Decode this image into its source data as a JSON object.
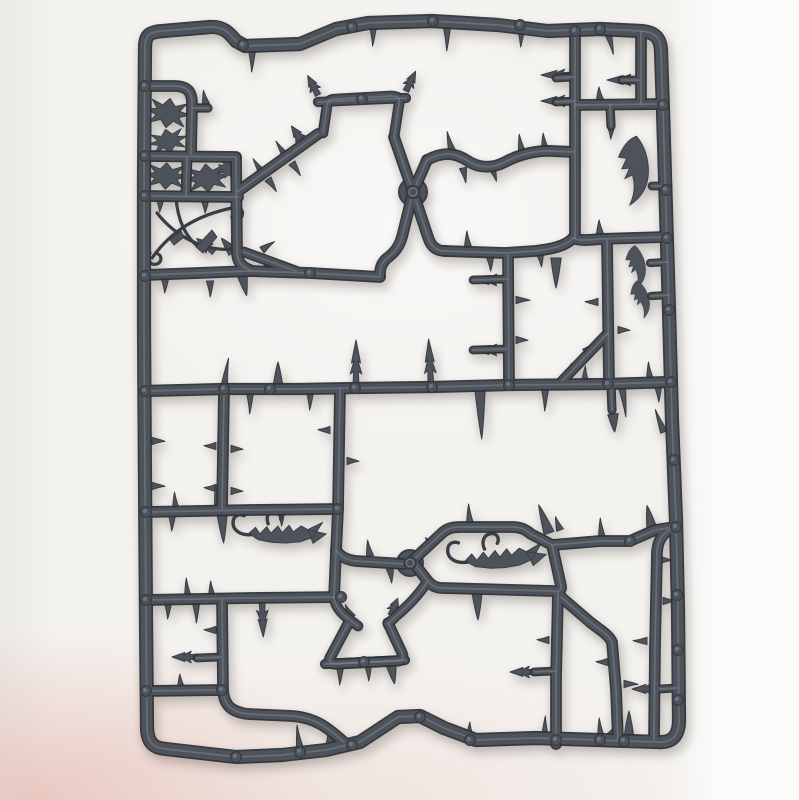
{
  "meta": {
    "subject": "Grey plastic injection-moulded sprue (model-kit runner frame) holding thorn, spike, hook and blade shaped scenery parts",
    "background": "White paper surface with soft photo shadows and a faint pink reflection along the bottom-left edge",
    "item_color_name": "dark grey polystyrene plastic",
    "orientation": "portrait photograph"
  },
  "palette": {
    "background_base": "#f4f2ef",
    "background_right": "#fcfcfb",
    "background_left": "#eceae7",
    "pink_tint_strong": "rgba(226,168,158,0.55)",
    "pink_tint_fade": "rgba(226,168,158,0)",
    "plastic": "#4e535b",
    "plastic_dark": "#393d44",
    "plastic_deep": "#2e3137",
    "plastic_light": "#8a909a"
  },
  "geometry": {
    "canvas": {
      "width": 799,
      "height": 800
    },
    "frame": {
      "d": "M 163,31 L 210,27 C 224,26 230,34 236,41 L 245,46 L 300,44 L 336,29 L 368,23 L 432,21 L 498,25 L 548,31 L 600,29 L 641,31 C 655,32 661,38 661,52 L 663,110 L 666,210 L 669,310 L 672,420 L 676,520 L 678,610 L 679,720 C 679,736 672,743 658,742 L 598,740 L 536,738 L 476,740 L 444,728 L 420,716 L 398,717 L 360,742 L 326,750 L 282,755 L 236,757 L 192,752 L 166,749 C 152,748 147,741 147,726 L 146,620 L 145,480 L 144,330 L 144,180 L 145,48 C 145,34 150,32 163,31 Z",
      "w": 12
    },
    "rails": [
      {
        "d": "M 145,391 L 224,389 L 300,389 L 355,388 L 432,387 L 509,385 L 608,384 L 671,382",
        "w": 10
      },
      {
        "d": "M 146,86 L 174,86 C 188,86 192,92 192,104 L 191,154",
        "w": 9.5
      },
      {
        "d": "M 192,108 L 208,108",
        "w": 7
      },
      {
        "d": "M 146,156 L 236,157",
        "w": 9.5
      },
      {
        "d": "M 187,158 L 186,196",
        "w": 8.5
      },
      {
        "d": "M 146,196 L 238,197",
        "w": 9.5
      },
      {
        "d": "M 236,158 L 237,252 C 237,262 242,267 250,270",
        "w": 9.5
      },
      {
        "d": "M 146,275 L 250,271 L 310,273 L 380,277",
        "w": 9.5
      },
      {
        "d": "M 237,192 L 318,134",
        "w": 9.5
      },
      {
        "d": "M 244,252 L 296,271",
        "w": 8.5
      },
      {
        "d": "M 323,133 L 327,106 C 328,100 331,99 337,99 L 391,96 C 398,96 400,98 399,104 L 394,137",
        "w": 8.5
      },
      {
        "d": "M 318,102 L 406,98",
        "w": 8
      },
      {
        "d": "M 394,137 L 413,192 L 428,237 C 431,247 437,251 445,251",
        "w": 9.5
      },
      {
        "d": "M 427,160 L 413,192 L 403,233 C 400,247 394,253 386,259 C 381,264 380,269 380,275",
        "w": 9.5
      },
      {
        "d": "M 427,160 C 444,151 456,153 468,161 C 480,169 494,168 505,162 C 520,154 538,150 552,151 L 574,152",
        "w": 9.5
      },
      {
        "d": "M 445,251 L 505,253 L 535,251 C 552,249 566,246 573,238",
        "w": 9.5
      },
      {
        "d": "M 575,31 L 575,238",
        "w": 9.5
      },
      {
        "d": "M 573,238 C 580,241 590,240 600,239 L 664,237",
        "w": 9.5
      },
      {
        "d": "M 607,240 L 609,384",
        "w": 9.5
      },
      {
        "d": "M 508,255 L 509,385",
        "w": 9.5
      },
      {
        "d": "M 575,105 L 662,104",
        "w": 9.5
      },
      {
        "d": "M 641,32 L 641,104",
        "w": 9.5
      },
      {
        "d": "M 610,104 L 611,126",
        "w": 7
      },
      {
        "d": "M 611,385 L 612,410",
        "w": 7
      },
      {
        "d": "M 562,381 L 608,333",
        "w": 8.5
      },
      {
        "d": "M 340,389 L 338,510 L 336,552 L 334,598",
        "w": 9.5
      },
      {
        "d": "M 336,550 C 340,557 348,560 356,561 L 404,564",
        "w": 9.5
      },
      {
        "d": "M 334,598 C 336,608 342,614 350,620 L 358,626",
        "w": 8.5
      },
      {
        "d": "M 146,512 L 250,510 L 338,509",
        "w": 9.5
      },
      {
        "d": "M 146,600 L 250,598 L 341,597",
        "w": 9.5
      },
      {
        "d": "M 224,390 L 222,509",
        "w": 9.5
      },
      {
        "d": "M 222,600 L 223,690 C 224,706 232,712 248,714 L 292,716 C 318,718 330,730 344,742",
        "w": 9.5
      },
      {
        "d": "M 146,691 L 222,690",
        "w": 9.5
      },
      {
        "d": "M 412,561 L 441,534 C 447,528 453,527 461,527 L 512,527 C 520,527 525,529 531,534 L 552,545 L 561,586 C 562,591 558,592 552,591 L 443,588 C 435,588 431,585 427,580 Z",
        "w": 9.5
      },
      {
        "d": "M 552,545 L 600,541 L 630,541 L 655,530 L 674,527",
        "w": 9.5
      },
      {
        "d": "M 558,592 L 556,680 L 556,744",
        "w": 9.5
      },
      {
        "d": "M 561,597 L 590,622 C 600,630 608,634 612,642 L 616,690 L 618,740",
        "w": 9.5
      },
      {
        "d": "M 672,528 C 662,534 658,540 657,552 L 655,648 L 654,740",
        "w": 9.5
      },
      {
        "d": "M 427,582 C 418,596 408,606 396,616 L 388,624",
        "w": 8.5
      },
      {
        "d": "M 348,624 L 331,656 C 328,661 330,664 335,664 L 397,661 C 402,661 404,658 402,653 L 388,623",
        "w": 9
      },
      {
        "d": "M 325,664 L 405,660",
        "w": 8
      },
      {
        "d": "M 652,186 L 668,186",
        "w": 6.5
      },
      {
        "d": "M 650,263 L 668,262",
        "w": 6
      },
      {
        "d": "M 651,296 L 669,295",
        "w": 6
      },
      {
        "d": "M 660,689 L 677,688",
        "w": 6.5
      },
      {
        "d": "M 197,658 L 221,657",
        "w": 6.5
      },
      {
        "d": "M 534,672 L 555,671",
        "w": 6.5
      },
      {
        "d": "M 473,280 L 507,279",
        "w": 6.5
      },
      {
        "d": "M 473,350 L 507,349",
        "w": 6.5
      },
      {
        "d": "M 556,78 L 574,77",
        "w": 6.5
      },
      {
        "d": "M 556,102 L 574,101",
        "w": 6.5
      },
      {
        "d": "M 622,80 L 640,80",
        "w": 6.5
      }
    ],
    "spikes": [
      [
        "thorn",
        252,
        50,
        180,
        22
      ],
      [
        "thorn",
        373,
        26,
        180,
        20
      ],
      [
        "thorn",
        447,
        27,
        180,
        24
      ],
      [
        "thorn",
        521,
        29,
        180,
        18
      ],
      [
        "thorn",
        608,
        33,
        165,
        22
      ],
      [
        "thorn",
        262,
        172,
        -35,
        16
      ],
      [
        "thorn",
        268,
        179,
        145,
        15
      ],
      [
        "thorn",
        286,
        156,
        -35,
        18
      ],
      [
        "thorn",
        292,
        163,
        145,
        15
      ],
      [
        "arrow",
        304,
        144,
        -35,
        22
      ],
      [
        "thorn",
        262,
        250,
        55,
        15
      ],
      [
        "thorn",
        271,
        263,
        -125,
        14
      ],
      [
        "arrow",
        318,
        95,
        -28,
        22
      ],
      [
        "arrow",
        406,
        91,
        26,
        22
      ],
      [
        "thorn",
        452,
        151,
        -15,
        20
      ],
      [
        "thorn",
        463,
        168,
        168,
        15
      ],
      [
        "thorn",
        492,
        168,
        160,
        14
      ],
      [
        "thorn",
        522,
        152,
        -10,
        18
      ],
      [
        "thorn",
        545,
        149,
        -8,
        16
      ],
      [
        "thorn",
        468,
        247,
        -5,
        16
      ],
      [
        "thorn",
        490,
        257,
        176,
        14
      ],
      [
        "thorn",
        600,
        234,
        -5,
        14
      ],
      [
        "thorn",
        600,
        100,
        -6,
        13
      ],
      [
        "thorn",
        611,
        126,
        180,
        13
      ],
      [
        "cone",
        556,
        258,
        180,
        30
      ],
      [
        "thorn",
        540,
        254,
        172,
        13
      ],
      [
        "thorn",
        516,
        300,
        90,
        14
      ],
      [
        "thorn",
        516,
        340,
        90,
        12
      ],
      [
        "thorn",
        598,
        302,
        -90,
        13
      ],
      [
        "thorn",
        618,
        330,
        90,
        12
      ],
      [
        "arrow",
        505,
        280,
        -90,
        32
      ],
      [
        "arrow",
        505,
        350,
        -90,
        32
      ],
      [
        "thorn",
        585,
        352,
        48,
        13
      ],
      [
        "thorn",
        574,
        366,
        -132,
        12
      ],
      [
        "thorn",
        224,
        388,
        8,
        30
      ],
      [
        "cone",
        278,
        388,
        0,
        26
      ],
      [
        "arrow",
        356,
        386,
        0,
        46
      ],
      [
        "arrow",
        431,
        385,
        -3,
        46
      ],
      [
        "thorn",
        585,
        382,
        0,
        16
      ],
      [
        "thorn",
        650,
        380,
        -6,
        18
      ],
      [
        "thorn",
        250,
        392,
        180,
        22
      ],
      [
        "thorn",
        310,
        392,
        180,
        18
      ],
      [
        "cone",
        480,
        389,
        178,
        50
      ],
      [
        "thorn",
        545,
        389,
        180,
        22
      ],
      [
        "thorn",
        622,
        387,
        172,
        30
      ],
      [
        "thorn",
        658,
        386,
        176,
        16
      ],
      [
        "cone",
        613,
        414,
        175,
        18
      ],
      [
        "thorn",
        216,
        446,
        -90,
        12
      ],
      [
        "thorn",
        231,
        449,
        90,
        12
      ],
      [
        "thorn",
        216,
        488,
        -90,
        12
      ],
      [
        "thorn",
        231,
        491,
        90,
        12
      ],
      [
        "thorn",
        152,
        441,
        90,
        13
      ],
      [
        "thorn",
        152,
        486,
        90,
        13
      ],
      [
        "thorn",
        176,
        510,
        -6,
        18
      ],
      [
        "thorn",
        218,
        508,
        -8,
        22
      ],
      [
        "thorn",
        172,
        515,
        180,
        16
      ],
      [
        "cone",
        222,
        513,
        177,
        30
      ],
      [
        "thorn",
        281,
        512,
        176,
        14
      ],
      [
        "thorn",
        188,
        598,
        -6,
        20
      ],
      [
        "thorn",
        212,
        597,
        -6,
        16
      ],
      [
        "thorn",
        168,
        603,
        180,
        16
      ],
      [
        "thorn",
        196,
        603,
        178,
        20
      ],
      [
        "arrow",
        198,
        657,
        -90,
        26
      ],
      [
        "thorn",
        216,
        630,
        -90,
        12
      ],
      [
        "thorn",
        181,
        688,
        -6,
        14
      ],
      [
        "arrow",
        262,
        601,
        178,
        36
      ],
      [
        "thorn",
        300,
        749,
        -8,
        24
      ],
      [
        "cone",
        331,
        749,
        -5,
        20
      ],
      [
        "thorn",
        470,
        738,
        -2,
        16
      ],
      [
        "thorn",
        545,
        738,
        0,
        22
      ],
      [
        "thorn",
        601,
        738,
        -6,
        20
      ],
      [
        "cone",
        629,
        739,
        0,
        28
      ],
      [
        "thorn",
        653,
        737,
        -12,
        16
      ],
      [
        "thorn",
        609,
        737,
        38,
        22
      ],
      [
        "arrow",
        536,
        672,
        -90,
        26
      ],
      [
        "thorn",
        549,
        640,
        -90,
        12
      ],
      [
        "thorn",
        624,
        684,
        90,
        14
      ],
      [
        "thorn",
        608,
        662,
        -90,
        12
      ],
      [
        "arrow",
        660,
        689,
        -90,
        28
      ],
      [
        "thorn",
        647,
        641,
        -90,
        14
      ],
      [
        "thorn",
        663,
        601,
        90,
        12
      ],
      [
        "thorn",
        664,
        432,
        -22,
        24
      ],
      [
        "thorn",
        602,
        538,
        -6,
        20
      ],
      [
        "cone",
        652,
        529,
        -12,
        24
      ],
      [
        "thorn",
        470,
        524,
        -5,
        20
      ],
      [
        "cone",
        549,
        533,
        -20,
        30
      ],
      [
        "cone",
        477,
        592,
        178,
        28
      ],
      [
        "thorn",
        434,
        546,
        -48,
        12
      ],
      [
        "thorn",
        340,
        667,
        180,
        18
      ],
      [
        "thorn",
        368,
        665,
        176,
        16
      ],
      [
        "cone",
        391,
        664,
        170,
        20
      ],
      [
        "thorn",
        352,
        617,
        -30,
        14
      ],
      [
        "arrow",
        391,
        615,
        22,
        18
      ],
      [
        "thorn",
        330,
        430,
        -90,
        12
      ],
      [
        "thorn",
        347,
        461,
        90,
        12
      ],
      [
        "thorn",
        342,
        611,
        -48,
        12
      ],
      [
        "thorn",
        370,
        556,
        -10,
        16
      ],
      [
        "thorn",
        390,
        569,
        172,
        14
      ],
      [
        "thorn",
        206,
        104,
        -12,
        14
      ],
      [
        "thorn",
        160,
        200,
        180,
        12
      ],
      [
        "thorn",
        205,
        201,
        178,
        12
      ],
      [
        "thorn",
        165,
        279,
        180,
        14
      ],
      [
        "thorn",
        210,
        281,
        178,
        16
      ],
      [
        "cone",
        242,
        274,
        168,
        22
      ],
      [
        "arrow",
        214,
        252,
        -52,
        22
      ],
      [
        "cone",
        233,
        252,
        -40,
        18
      ],
      [
        "arrow",
        573,
        75,
        -90,
        32
      ],
      [
        "arrow",
        573,
        101,
        -90,
        32
      ],
      [
        "arrow",
        639,
        80,
        -90,
        32
      ],
      [
        "thorn",
        560,
        530,
        -20,
        14
      ],
      [
        "thorn",
        660,
        560,
        90,
        12
      ]
    ],
    "templates": {
      "holly": "M0,-14 L5,-7 L14,-11 L9,-3 L18,-1 L9,3 L14,11 L5,7 L0,14 L-5,7 L-14,11 L-9,3 L-18,-1 L-9,-3 L-14,-11 L-5,-7 Z",
      "claw": "M0,-34 C7,-24 10,-10 8,4 C6,18 -2,28 -14,34 C-8,24 -6,14 -8,4 L-16,7 L-10,-3 L-18,-3 L-12,-13 L-20,-15 C-14,-26 -8,-32 0,-34 Z",
      "scorpionBody": "M22,25 L28,18 L33,24 L39,16 L44,22 L50,14 L55,20 L61,12 L66,18 L73,11 L80,14 L94,5 L86,21 L74,27 L60,30 L46,31 L32,30 Z M80,14 L99,16 L87,27 Z",
      "scorpionHooks": "M24,26 C13,28 5,23 5,15 C5,9 10,6 15,8 M40,13 C36,5 40,-2 47,-2 C52,-2 54,3 52,7",
      "vinesCurves": "M152,258 C172,230 198,215 232,208 C239,205 244,210 242,216 C240,221 234,221 232,217 M157,213 C176,237 205,252 234,249 C241,251 242,258 236,260 M150,253 C146,259 150,266 157,264 C162,262 162,256 158,254 M176,198 C178,222 186,238 200,248",
      "vinesDaggers": "M196,247 L212,230 L217,237 L203,253 Z M170,240 L181,231 L184,237 L174,245 Z"
    },
    "ornaments": [
      {
        "t": "holly",
        "tr": "translate(168,113) rotate(8) scale(1.25,1.05)",
        "mode": "fill"
      },
      {
        "t": "holly",
        "tr": "translate(168,141) rotate(-12) scale(1.1,0.85)",
        "mode": "fill"
      },
      {
        "t": "holly",
        "tr": "translate(166,176) rotate(3) scale(1.2,0.95)",
        "mode": "fill"
      },
      {
        "t": "holly",
        "tr": "translate(207,178) rotate(-6) scale(1.25,1)",
        "mode": "fill"
      },
      {
        "t": "holly",
        "tr": "translate(228,169) rotate(20) scale(0.6,0.7)",
        "mode": "fill"
      },
      {
        "t": "claw",
        "tr": "translate(640,170) rotate(-6)",
        "mode": "fill"
      },
      {
        "t": "claw",
        "tr": "translate(640,266) rotate(-14) scale(0.62)",
        "mode": "fill"
      },
      {
        "t": "claw",
        "tr": "translate(644,298) rotate(-22) scale(0.55)",
        "mode": "fill"
      },
      {
        "t": "scorpionBody",
        "tr": "translate(230,506) rotate(7)",
        "mode": "fill"
      },
      {
        "t": "scorpionHooks",
        "tr": "translate(230,506) rotate(7)",
        "mode": "stroke",
        "sw": 3.4
      },
      {
        "t": "scorpionBody",
        "tr": "translate(443,534) rotate(2) scale(1.05)",
        "mode": "fill"
      },
      {
        "t": "scorpionHooks",
        "tr": "translate(443,534) rotate(2) scale(1.05)",
        "mode": "stroke",
        "sw": 3.2
      },
      {
        "t": "vinesCurves",
        "tr": "",
        "mode": "stroke",
        "sw": 3.2
      },
      {
        "t": "vinesDaggers",
        "tr": "",
        "mode": "fill"
      }
    ],
    "nubs": [
      [
        145,
        86
      ],
      [
        145,
        156
      ],
      [
        145,
        196
      ],
      [
        145,
        276
      ],
      [
        145,
        391
      ],
      [
        146,
        512
      ],
      [
        146,
        600
      ],
      [
        146,
        691
      ],
      [
        243,
        45
      ],
      [
        352,
        27
      ],
      [
        433,
        21
      ],
      [
        520,
        25
      ],
      [
        575,
        31
      ],
      [
        600,
        29
      ],
      [
        663,
        105
      ],
      [
        666,
        190
      ],
      [
        667,
        238
      ],
      [
        669,
        310
      ],
      [
        671,
        382
      ],
      [
        674,
        460
      ],
      [
        676,
        527
      ],
      [
        677,
        595
      ],
      [
        678,
        650
      ],
      [
        678,
        700
      ],
      [
        236,
        757
      ],
      [
        300,
        752
      ],
      [
        352,
        745
      ],
      [
        420,
        717
      ],
      [
        470,
        740
      ],
      [
        556,
        740
      ],
      [
        600,
        740
      ],
      [
        624,
        741
      ],
      [
        224,
        389
      ],
      [
        270,
        389
      ],
      [
        355,
        388
      ],
      [
        432,
        387
      ],
      [
        509,
        385
      ],
      [
        608,
        384
      ],
      [
        338,
        509
      ],
      [
        341,
        597
      ],
      [
        222,
        690
      ],
      [
        630,
        541
      ],
      [
        362,
        99
      ],
      [
        364,
        662
      ],
      [
        310,
        273
      ]
    ],
    "bosses": [
      {
        "cx": 413,
        "cy": 192,
        "r": 14
      },
      {
        "cx": 410,
        "cy": 563,
        "r": 13
      }
    ]
  }
}
